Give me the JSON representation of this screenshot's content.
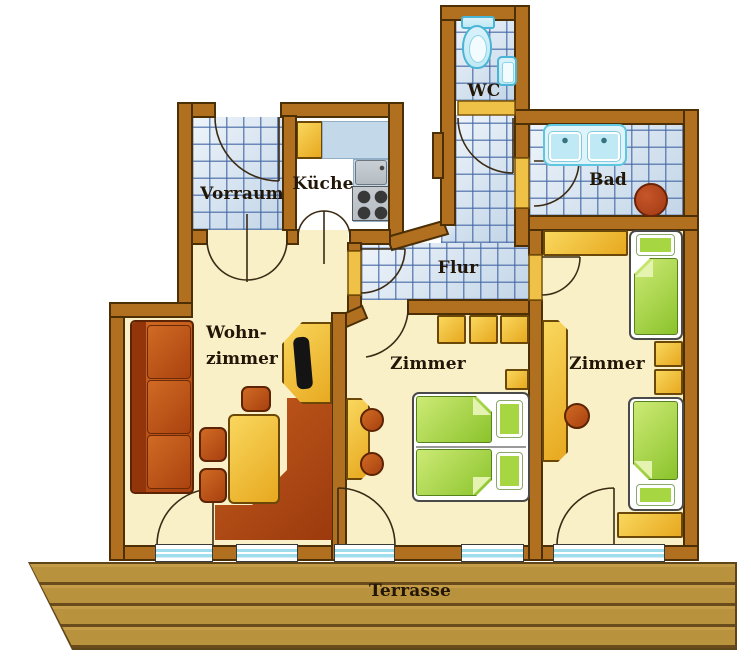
{
  "floor_plan": {
    "rooms": {
      "vorraum": {
        "label": "Vorraum"
      },
      "kueche": {
        "label": "Küche"
      },
      "wc": {
        "label": "WC"
      },
      "bad": {
        "label": "Bad"
      },
      "flur": {
        "label": "Flur"
      },
      "wohnzimmer": {
        "label_line1": "Wohn-",
        "label_line2": "zimmer"
      },
      "zimmer_mitte": {
        "label": "Zimmer"
      },
      "zimmer_rechts": {
        "label": "Zimmer"
      },
      "terrasse": {
        "label": "Terrasse"
      }
    },
    "colors": {
      "wall": "#b1701f",
      "wall_outline": "#4d2f05",
      "room_floor": "#f9f0c8",
      "tile_grout": "#4669a5",
      "tile_fill": "#c2d5e7",
      "furniture_red": "#b4511b",
      "furniture_yellow": "#f0c043",
      "bed_green": "#9fd23a",
      "sanitary_cyan": "#bfe9f4",
      "window_glass": "#9fdcec",
      "terrace_wood": "#b8923c",
      "label_text": "#221607"
    }
  }
}
